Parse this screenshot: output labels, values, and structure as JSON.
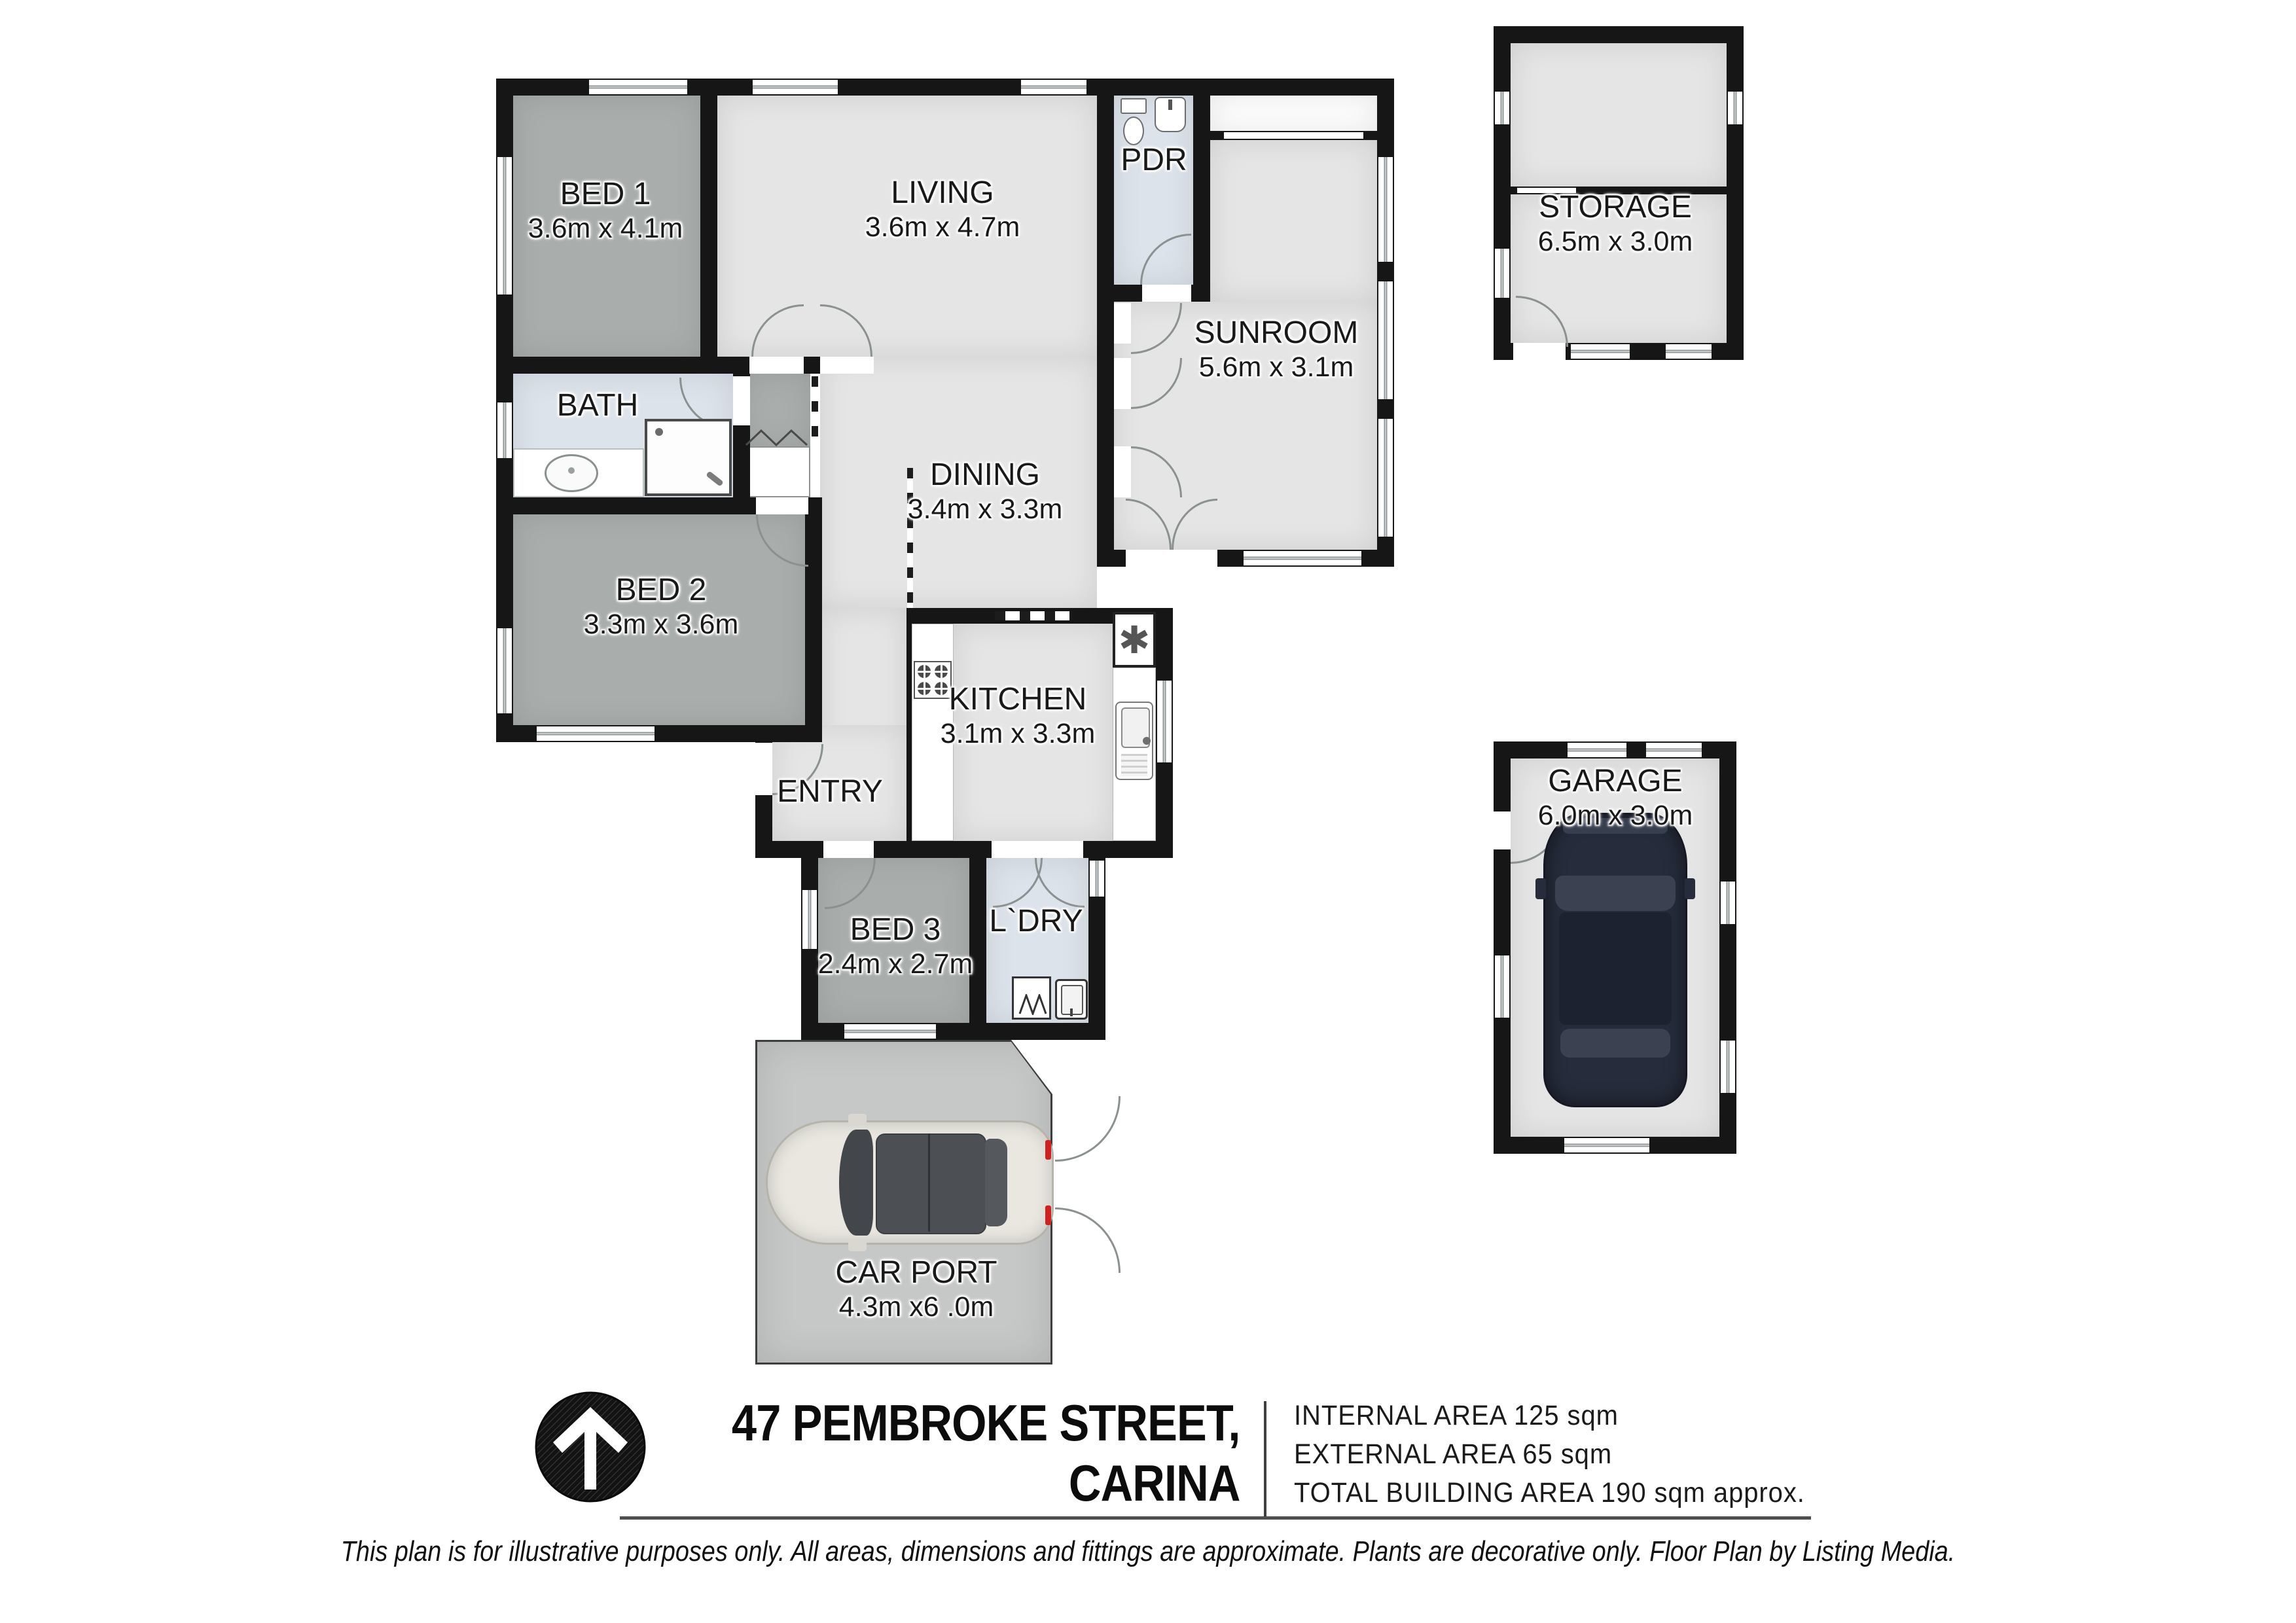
{
  "plan": {
    "rooms": {
      "bed1": {
        "name": "BED 1",
        "dims": "3.6m x 4.1m"
      },
      "living": {
        "name": "LIVING",
        "dims": "3.6m x 4.7m"
      },
      "pdr": {
        "name": "PDR"
      },
      "sunroom": {
        "name": "SUNROOM",
        "dims": "5.6m x 3.1m"
      },
      "bath": {
        "name": "BATH"
      },
      "dining": {
        "name": "DINING",
        "dims": "3.4m x 3.3m"
      },
      "bed2": {
        "name": "BED 2",
        "dims": "3.3m x 3.6m"
      },
      "kitchen": {
        "name": "KITCHEN",
        "dims": "3.1m x 3.3m"
      },
      "entry": {
        "name": "ENTRY"
      },
      "bed3": {
        "name": "BED 3",
        "dims": "2.4m x 2.7m"
      },
      "laundry": {
        "name": "L`DRY"
      },
      "carport": {
        "name": "CAR PORT",
        "dims": "4.3m x6 .0m"
      },
      "storage": {
        "name": "STORAGE",
        "dims": "6.5m x 3.0m"
      },
      "garage": {
        "name": "GARAGE",
        "dims": "6.0m x 3.0m"
      }
    },
    "symbols": {
      "hot_water": "✱"
    }
  },
  "footer": {
    "address_line1": "47 PEMBROKE STREET,",
    "address_line2": "CARINA",
    "areas": [
      "INTERNAL AREA 125 sqm",
      "EXTERNAL AREA 65 sqm",
      "TOTAL BUILDING AREA 190 sqm approx."
    ],
    "disclaimer": "This plan is for illustrative purposes only. All areas, dimensions and fittings are approximate. Plants are decorative only. Floor Plan by Listing Media."
  },
  "colors": {
    "wall": "#161616",
    "bedroom_fill": "#a9aeac",
    "living_fill": "#e4e5e4",
    "wet_area_fill": "#dce3ea",
    "carport_fill": "#c6c8c7",
    "car_navy": "#262c3c",
    "car_cream": "#e9e7e0",
    "taillight_red": "#cc2222"
  }
}
